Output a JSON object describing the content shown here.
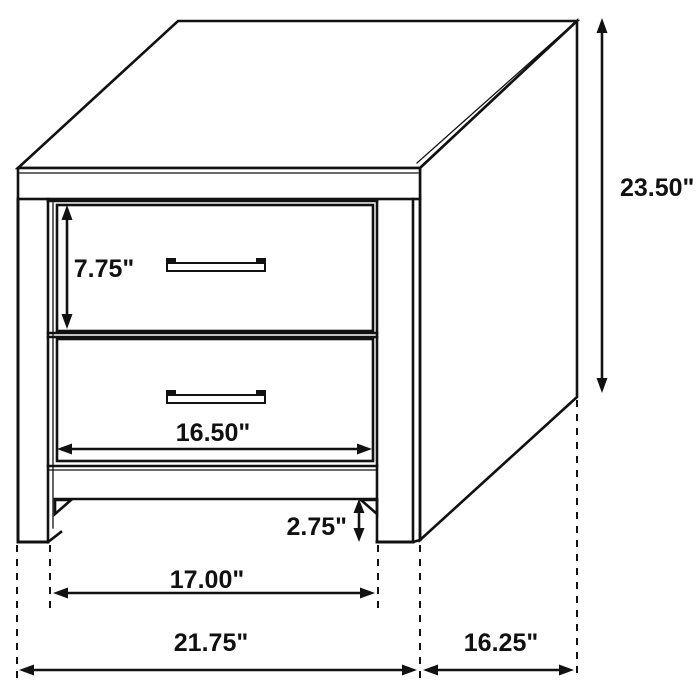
{
  "diagram": {
    "type": "furniture-dimension-drawing",
    "subject": "Two-drawer nightstand",
    "unit": "inches",
    "line_color": "#111111",
    "background_color": "#ffffff",
    "drawer_count": 2,
    "dimensions": {
      "overall_height": {
        "label": "23.50\"",
        "value": 23.5,
        "orientation": "vertical"
      },
      "top_drawer_height": {
        "label": "7.75\"",
        "value": 7.75,
        "orientation": "vertical"
      },
      "drawer_width": {
        "label": "16.50\"",
        "value": 16.5,
        "orientation": "horizontal"
      },
      "base_height": {
        "label": "2.75\"",
        "value": 2.75,
        "orientation": "vertical"
      },
      "inner_leg_span": {
        "label": "17.00\"",
        "value": 17.0,
        "orientation": "horizontal"
      },
      "overall_width": {
        "label": "21.75\"",
        "value": 21.75,
        "orientation": "horizontal"
      },
      "overall_depth": {
        "label": "16.25\"",
        "value": 16.25,
        "orientation": "horizontal"
      }
    }
  }
}
